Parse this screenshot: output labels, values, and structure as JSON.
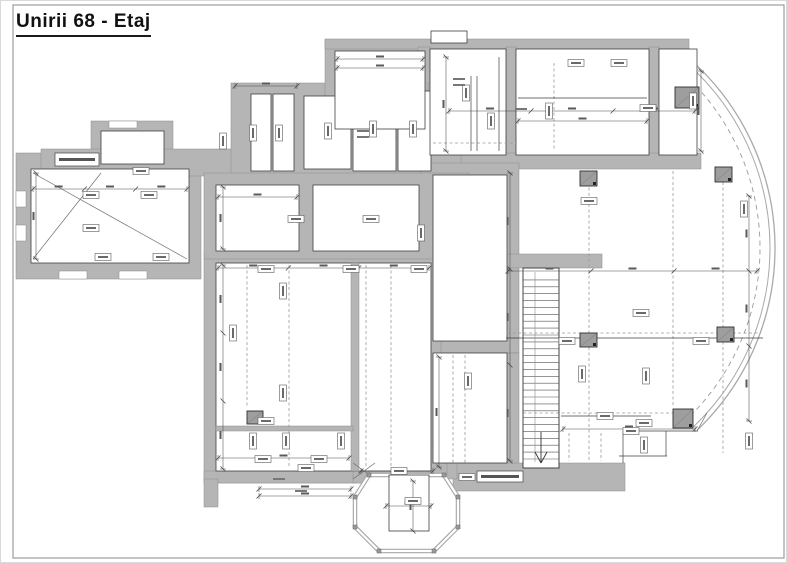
{
  "title": "Unirii 68 - Etaj",
  "plan": {
    "colors": {
      "wall": "#b5b5b5",
      "wallEdge": "#8d8d8d",
      "line": "#3f3f3f",
      "dim": "#4a4a4a",
      "dashed": "#9a9a9a",
      "column": "#9e9e9e",
      "columnEdge": "#2f2f2f",
      "tagBorder": "#5a5a5a",
      "tagMark": "#6a6a6a",
      "arc": "#a9a9a9",
      "frame": "#9c9c9c",
      "smudge": "#5a5a5a",
      "white": "#ffffff"
    },
    "frame": {
      "x1": 12,
      "y1": 4,
      "x2": 783,
      "y2": 557
    },
    "walls": [
      [
        15,
        152,
        185,
        126
      ],
      [
        90,
        120,
        82,
        52
      ],
      [
        40,
        148,
        270,
        27
      ],
      [
        230,
        82,
        240,
        103
      ],
      [
        298,
        180,
        14,
        82
      ],
      [
        324,
        40,
        110,
        96
      ],
      [
        324,
        38,
        364,
        10
      ],
      [
        417,
        46,
        12,
        116
      ],
      [
        427,
        82,
        30,
        14
      ],
      [
        505,
        46,
        10,
        110
      ],
      [
        648,
        46,
        10,
        118
      ],
      [
        674,
        86,
        24,
        22
      ],
      [
        460,
        152,
        240,
        16
      ],
      [
        420,
        162,
        98,
        190
      ],
      [
        398,
        252,
        34,
        100
      ],
      [
        420,
        352,
        12,
        118
      ],
      [
        506,
        352,
        12,
        118
      ],
      [
        505,
        253,
        96,
        14
      ],
      [
        203,
        250,
        237,
        232
      ],
      [
        203,
        172,
        265,
        86
      ],
      [
        203,
        470,
        152,
        12
      ],
      [
        203,
        478,
        14,
        28
      ],
      [
        452,
        462,
        172,
        28
      ],
      [
        420,
        462,
        36,
        16
      ],
      [
        352,
        460,
        16,
        22
      ],
      [
        428,
        444,
        18,
        36
      ]
    ],
    "slits": [
      [
        15,
        190,
        10,
        16
      ],
      [
        15,
        224,
        10,
        16
      ],
      [
        58,
        270,
        28,
        8
      ],
      [
        118,
        270,
        28,
        8
      ],
      [
        108,
        120,
        28,
        7
      ]
    ],
    "rooms": [
      [
        30,
        168,
        158,
        94
      ],
      [
        100,
        130,
        63,
        33
      ],
      [
        250,
        93,
        20,
        77
      ],
      [
        272,
        93,
        21,
        77
      ],
      [
        303,
        95,
        47,
        73
      ],
      [
        352,
        93,
        43,
        77
      ],
      [
        397,
        90,
        33,
        80
      ],
      [
        334,
        50,
        90,
        78
      ],
      [
        429,
        48,
        76,
        106
      ],
      [
        515,
        48,
        133,
        106
      ],
      [
        658,
        48,
        38,
        106
      ],
      [
        215,
        184,
        83,
        66
      ],
      [
        312,
        184,
        106,
        66
      ],
      [
        432,
        174,
        74,
        166
      ],
      [
        432,
        352,
        74,
        110
      ],
      [
        215,
        262,
        215,
        208
      ],
      [
        522,
        267,
        36,
        200
      ],
      [
        430,
        30,
        36,
        12
      ]
    ],
    "inner_walls": [
      [
        350,
        262,
        8,
        208
      ],
      [
        215,
        425,
        137,
        5
      ]
    ],
    "dashed_v": [
      [
        553,
        62,
        150
      ],
      [
        588,
        170,
        460
      ],
      [
        672,
        170,
        406
      ],
      [
        722,
        170,
        452
      ],
      [
        246,
        264,
        406
      ],
      [
        288,
        264,
        466
      ],
      [
        390,
        264,
        466
      ],
      [
        452,
        354,
        464
      ],
      [
        464,
        354,
        464
      ],
      [
        365,
        264,
        466
      ],
      [
        568,
        432,
        460
      ],
      [
        600,
        432,
        460
      ]
    ],
    "dashed_h": [
      [
        332,
        506,
        760
      ],
      [
        412,
        522,
        688
      ],
      [
        142,
        432,
        516
      ]
    ],
    "solid_h": [
      [
        337,
        505,
        762
      ],
      [
        430,
        622,
        697
      ],
      [
        455,
        618,
        666
      ],
      [
        415,
        560,
        650
      ],
      [
        97,
        517,
        646
      ]
    ],
    "solid_v": [
      [
        558,
        267,
        465
      ],
      [
        622,
        430,
        462
      ],
      [
        665,
        430,
        455
      ],
      [
        470,
        75,
        150
      ],
      [
        476,
        75,
        150
      ],
      [
        498,
        56,
        150
      ]
    ],
    "diagonals": [
      [
        32,
        172,
        186,
        258
      ],
      [
        32,
        258,
        100,
        172
      ],
      [
        352,
        462,
        374,
        478
      ],
      [
        374,
        462,
        352,
        478
      ],
      [
        696,
        430,
        706,
        412
      ]
    ],
    "dim_h": [
      [
        58,
        336,
        422
      ],
      [
        67,
        336,
        422
      ],
      [
        85,
        234,
        296
      ],
      [
        110,
        448,
        694
      ],
      [
        120,
        517,
        646
      ],
      [
        188,
        32,
        186
      ],
      [
        196,
        217,
        296
      ],
      [
        267,
        217,
        428
      ],
      [
        270,
        507,
        756
      ],
      [
        428,
        562,
        694
      ],
      [
        457,
        217,
        348
      ],
      [
        470,
        360,
        432
      ],
      [
        488,
        258,
        350
      ],
      [
        495,
        258,
        350
      ],
      [
        505,
        385,
        430
      ]
    ],
    "dim_v": [
      [
        35,
        172,
        258
      ],
      [
        222,
        186,
        248
      ],
      [
        222,
        264,
        468
      ],
      [
        438,
        356,
        466
      ],
      [
        445,
        56,
        150
      ],
      [
        700,
        70,
        150
      ],
      [
        748,
        195,
        420
      ],
      [
        509,
        172,
        460
      ],
      [
        412,
        480,
        530
      ]
    ],
    "columns": [
      [
        579,
        170,
        17,
        15
      ],
      [
        714,
        166,
        17,
        15
      ],
      [
        579,
        332,
        17,
        14
      ],
      [
        716,
        326,
        17,
        15
      ],
      [
        672,
        408,
        20,
        19
      ],
      [
        246,
        410,
        16,
        13
      ],
      [
        674,
        86,
        24,
        21
      ]
    ],
    "tags_h": [
      [
        90,
        194
      ],
      [
        148,
        194
      ],
      [
        90,
        227
      ],
      [
        102,
        256
      ],
      [
        160,
        256
      ],
      [
        140,
        170
      ],
      [
        265,
        268
      ],
      [
        350,
        268
      ],
      [
        418,
        268
      ],
      [
        647,
        107
      ],
      [
        640,
        312
      ],
      [
        566,
        340
      ],
      [
        700,
        340
      ],
      [
        588,
        200
      ],
      [
        262,
        458
      ],
      [
        318,
        458
      ],
      [
        398,
        470
      ],
      [
        466,
        476
      ],
      [
        630,
        430
      ],
      [
        604,
        415
      ],
      [
        412,
        500
      ],
      [
        295,
        218
      ],
      [
        370,
        218
      ],
      [
        575,
        62
      ],
      [
        618,
        62
      ],
      [
        265,
        420
      ],
      [
        305,
        467
      ],
      [
        643,
        422
      ]
    ],
    "tags_v": [
      [
        252,
        132
      ],
      [
        278,
        132
      ],
      [
        327,
        130
      ],
      [
        372,
        128
      ],
      [
        412,
        128
      ],
      [
        465,
        92
      ],
      [
        490,
        120
      ],
      [
        548,
        110
      ],
      [
        692,
        100
      ],
      [
        743,
        208
      ],
      [
        282,
        290
      ],
      [
        232,
        332
      ],
      [
        282,
        392
      ],
      [
        467,
        380
      ],
      [
        581,
        373
      ],
      [
        645,
        375
      ],
      [
        420,
        232
      ],
      [
        222,
        140
      ],
      [
        252,
        440
      ],
      [
        285,
        440
      ],
      [
        340,
        440
      ],
      [
        643,
        444
      ],
      [
        748,
        440
      ]
    ],
    "label_boxes": [
      [
        54,
        152,
        44,
        13
      ],
      [
        476,
        470,
        46,
        11
      ]
    ],
    "micro_marks": [
      [
        458,
        78
      ],
      [
        458,
        84
      ],
      [
        362,
        130
      ],
      [
        362,
        136
      ],
      [
        278,
        478
      ],
      [
        520,
        108
      ],
      [
        300,
        490
      ]
    ],
    "stair": {
      "x": 522,
      "y": 267,
      "w": 36,
      "h": 200,
      "treads": 27
    },
    "octagon": {
      "points": [
        [
          368,
          474
        ],
        [
          443,
          474
        ],
        [
          457,
          496
        ],
        [
          457,
          526
        ],
        [
          433,
          550
        ],
        [
          378,
          550
        ],
        [
          354,
          526
        ],
        [
          354,
          496
        ]
      ],
      "inner_rect": [
        388,
        474,
        40,
        56
      ]
    },
    "arc": {
      "cx": 522,
      "cy": 247,
      "r_outer": 252,
      "r_inner": 247,
      "r_dash": 237,
      "start_deg": -47.5,
      "end_deg": 46.3
    }
  }
}
